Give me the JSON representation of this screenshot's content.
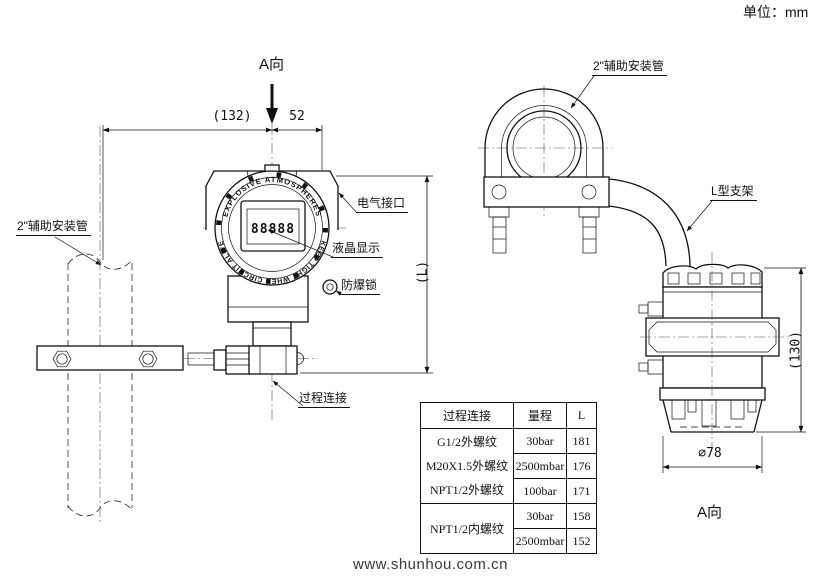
{
  "meta": {
    "unit_note": "单位：mm",
    "website": "www.shunhou.com.cn"
  },
  "front_view": {
    "view_label": "A向",
    "dims": {
      "width_total": "(132)",
      "width_right": "52",
      "height": "(L)"
    },
    "callouts": {
      "aux_pipe": "2\"辅助安装管",
      "electrical_port": "电气接口",
      "lcd_display": "液晶显示",
      "explosion_proof_lock": "防爆锁",
      "process_connection": "过程连接"
    },
    "device": {
      "lcd_digits": "88888",
      "bezel_text_top": "EXPLOSIVE ATMOSPHERES",
      "bezel_text_bottom": "KEEP TIGHT WHEN CIRCUIT ALIVE"
    }
  },
  "side_view": {
    "view_label": "A向",
    "dims": {
      "height": "(130)",
      "diameter": "∅78"
    },
    "callouts": {
      "aux_pipe": "2\"辅助安装管",
      "bracket": "L型支架"
    }
  },
  "table": {
    "headers": [
      "过程连接",
      "量程",
      "L"
    ],
    "group1_connections": [
      "G1/2外螺纹",
      "M20X1.5外螺纹",
      "NPT1/2外螺纹"
    ],
    "group1_rows": [
      {
        "range": "30bar",
        "l": "181"
      },
      {
        "range": "2500mbar",
        "l": "176"
      },
      {
        "range": "100bar",
        "l": "171"
      }
    ],
    "group2_connection": "NPT1/2内螺纹",
    "group2_rows": [
      {
        "range": "30bar",
        "l": "158"
      },
      {
        "range": "2500mbar",
        "l": "152"
      }
    ]
  }
}
